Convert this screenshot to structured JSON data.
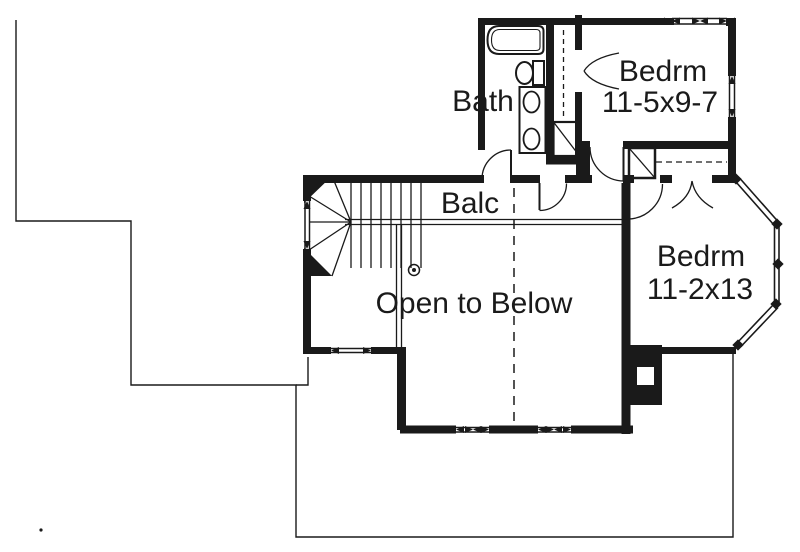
{
  "colors": {
    "ink": "#1a1a1a",
    "paper": "#ffffff"
  },
  "rooms": {
    "bath": {
      "label": "Bath"
    },
    "bedroom1": {
      "label": "Bedrm",
      "size": "11-5x9-7"
    },
    "balcony": {
      "label": "Balc"
    },
    "bedroom2": {
      "label": "Bedrm",
      "size": "11-2x13"
    },
    "open_area": {
      "label": "Open to Below"
    }
  }
}
